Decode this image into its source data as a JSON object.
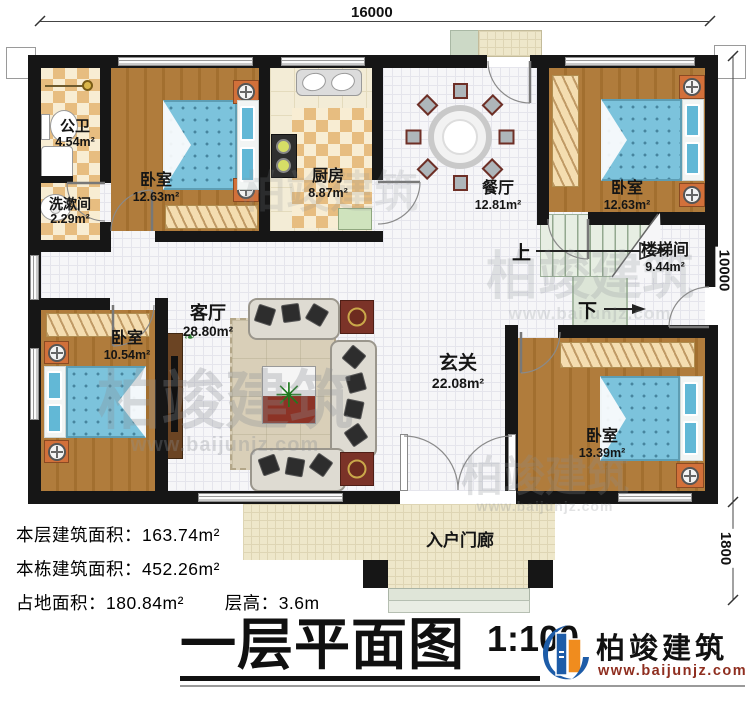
{
  "dimensions": {
    "top": "16000",
    "right_main": "10000",
    "right_porch": "1800"
  },
  "rooms": {
    "public_bath": {
      "name": "公卫",
      "area": "4.54m²"
    },
    "washroom": {
      "name": "洗漱间",
      "area": "2.29m²"
    },
    "bedroom_tl": {
      "name": "卧室",
      "area": "12.63m²"
    },
    "kitchen": {
      "name": "厨房",
      "area": "8.87m²"
    },
    "dining": {
      "name": "餐厅",
      "area": "12.81m²"
    },
    "bedroom_tr": {
      "name": "卧室",
      "area": "12.63m²"
    },
    "stairwell": {
      "name": "楼梯间",
      "area": "9.44m²"
    },
    "foyer": {
      "name": "玄关",
      "area": "22.08m²"
    },
    "living": {
      "name": "客厅",
      "area": "28.80m²"
    },
    "bedroom_bl": {
      "name": "卧室",
      "area": "10.54m²"
    },
    "bedroom_br": {
      "name": "卧室",
      "area": "13.39m²"
    },
    "porch": {
      "name": "入户门廊"
    }
  },
  "stairs": {
    "up": "上",
    "down": "下"
  },
  "stats": {
    "floor_area_label": "本层建筑面积：",
    "floor_area_value": "163.74m²",
    "building_area_label": "本栋建筑面积：",
    "building_area_value": "452.26m²",
    "footprint_label": "占地面积：",
    "footprint_value": "180.84m²",
    "height_label": "层高：",
    "height_value": "3.6m"
  },
  "title": {
    "text": "一层平面图",
    "scale": "1:100"
  },
  "logo": {
    "brand": "柏竣建筑",
    "url": "www.baijunjz.com"
  },
  "watermark": {
    "brand": "柏竣建筑",
    "url": "www.baijunjz.com"
  }
}
